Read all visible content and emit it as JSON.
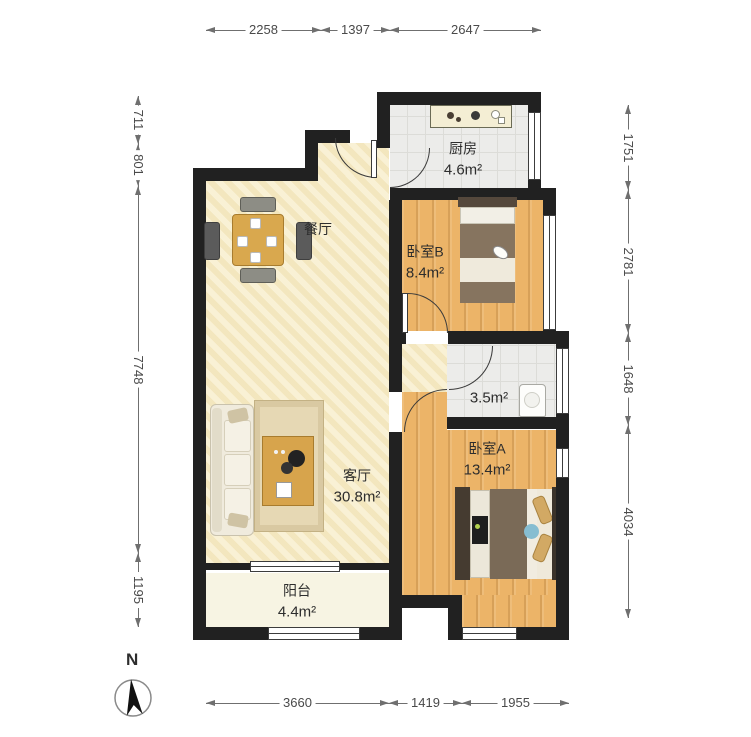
{
  "rooms": {
    "kitchen": {
      "name": "厨房",
      "area": "4.6m²"
    },
    "bedroom_b": {
      "name": "卧室B",
      "area": "8.4m²"
    },
    "dining": {
      "name": "餐厅"
    },
    "living": {
      "name": "客厅",
      "area": "30.8m²"
    },
    "bathroom": {
      "area": "3.5m²"
    },
    "bedroom_a": {
      "name": "卧室A",
      "area": "13.4m²"
    },
    "balcony": {
      "name": "阳台",
      "area": "4.4m²"
    }
  },
  "dimensions": {
    "top": [
      "2258",
      "1397",
      "2647"
    ],
    "left": [
      "711",
      "801",
      "7748",
      "1195"
    ],
    "right": [
      "1751",
      "2781",
      "1648",
      "4034"
    ],
    "bottom": [
      "3660",
      "1419",
      "1955"
    ]
  },
  "compass": {
    "label": "N"
  },
  "colors": {
    "wall": "#212121",
    "wood_floor": "#ecb468",
    "cream_floor": "#f7ecc7",
    "tile_floor": "#ececea",
    "dimension_text": "#4a4a4a"
  }
}
